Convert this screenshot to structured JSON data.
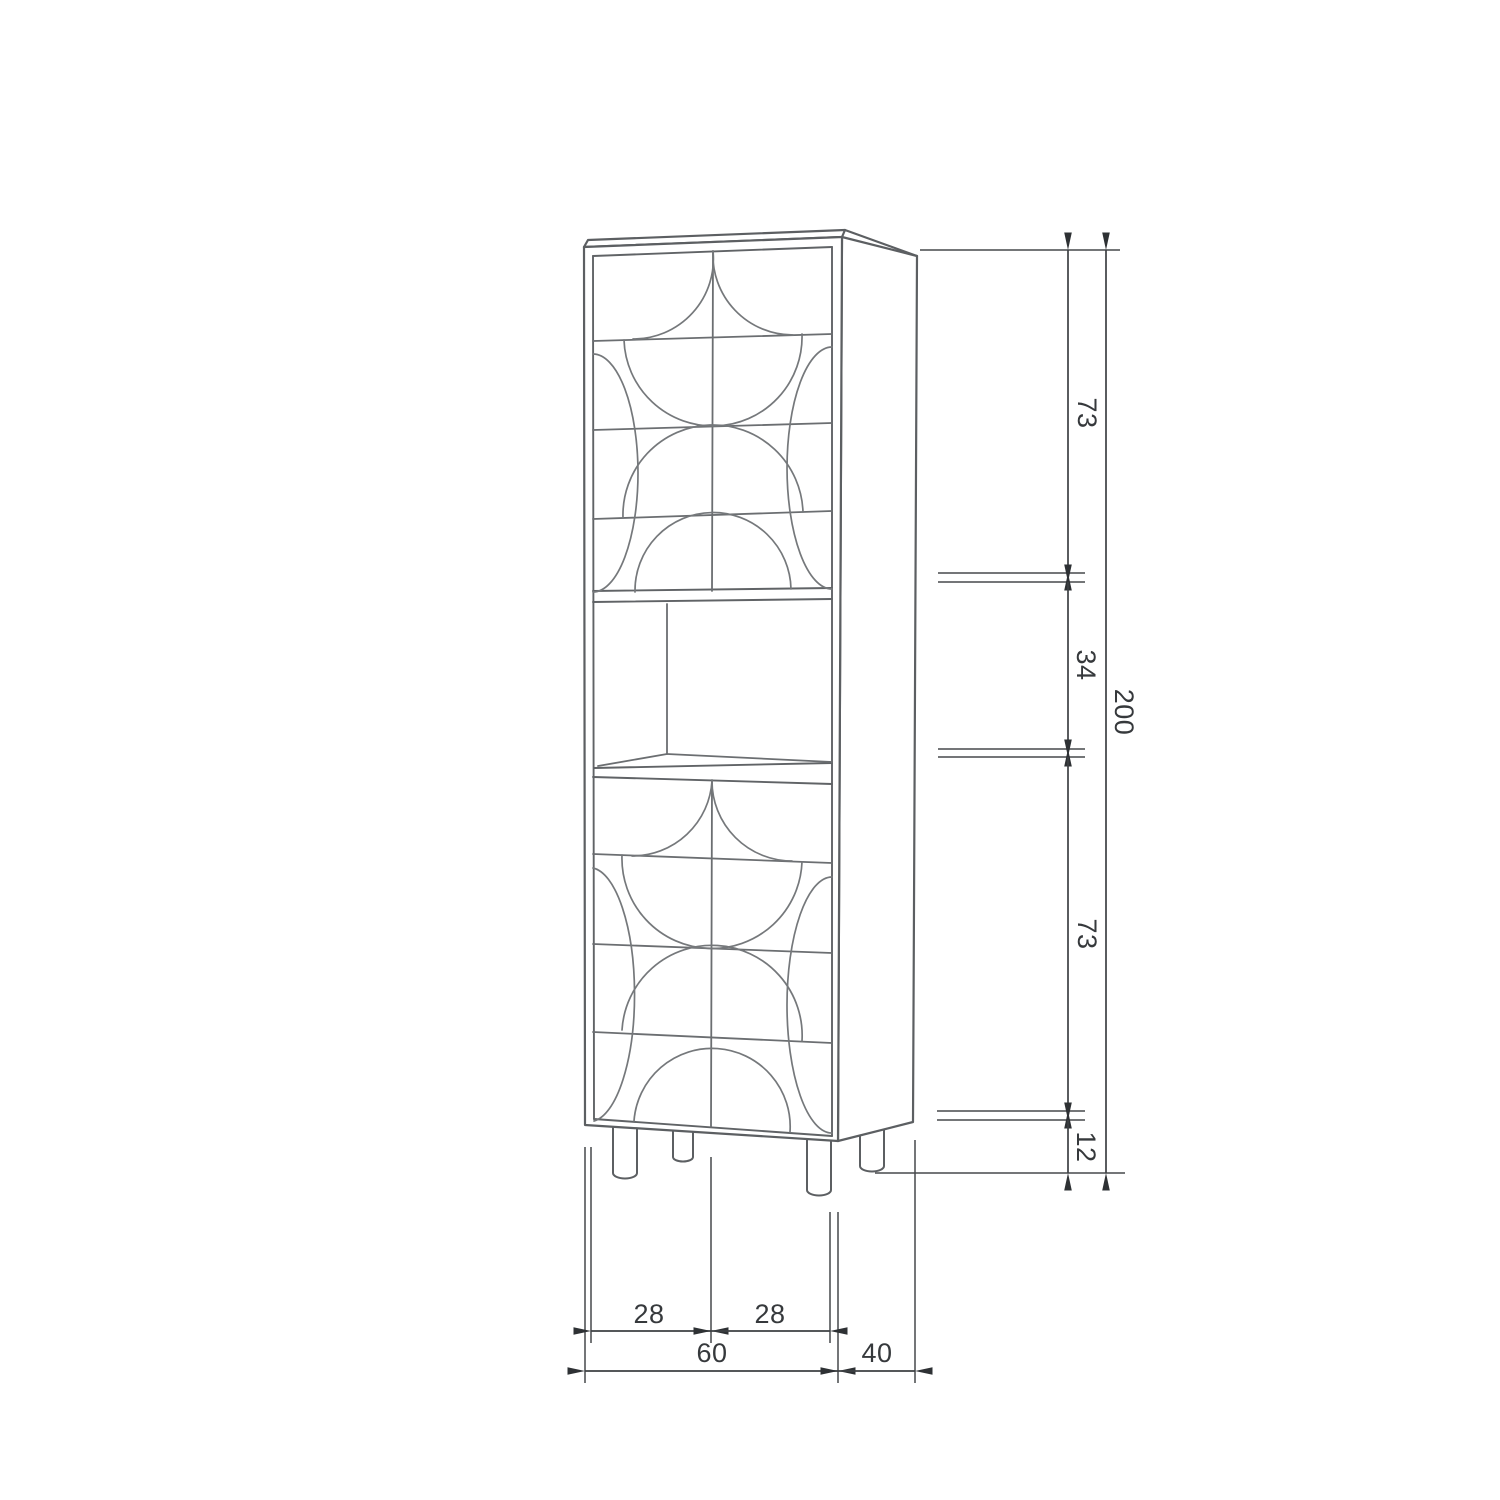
{
  "page": {
    "background": "#ffffff"
  },
  "drawing": {
    "kind": "furniture technical drawing",
    "subject": "tall two-door cabinet with carved arc relief doors, open middle shelf compartment and round legs",
    "view": "three-quarter front-right line perspective"
  },
  "dimension_labels": {
    "top_door_height": "73",
    "shelf_height": "34",
    "bottom_door_height": "73",
    "leg_height": "12",
    "total_height": "200",
    "door_left_width": "28",
    "door_right_width": "28",
    "total_width": "60",
    "total_depth": "40"
  },
  "style": {
    "outline_color": "#5c5f62",
    "pattern_color": "#75787b",
    "dimension_color": "#3d4043",
    "text_color": "#36393c",
    "arrow_color": "#2e3134"
  }
}
